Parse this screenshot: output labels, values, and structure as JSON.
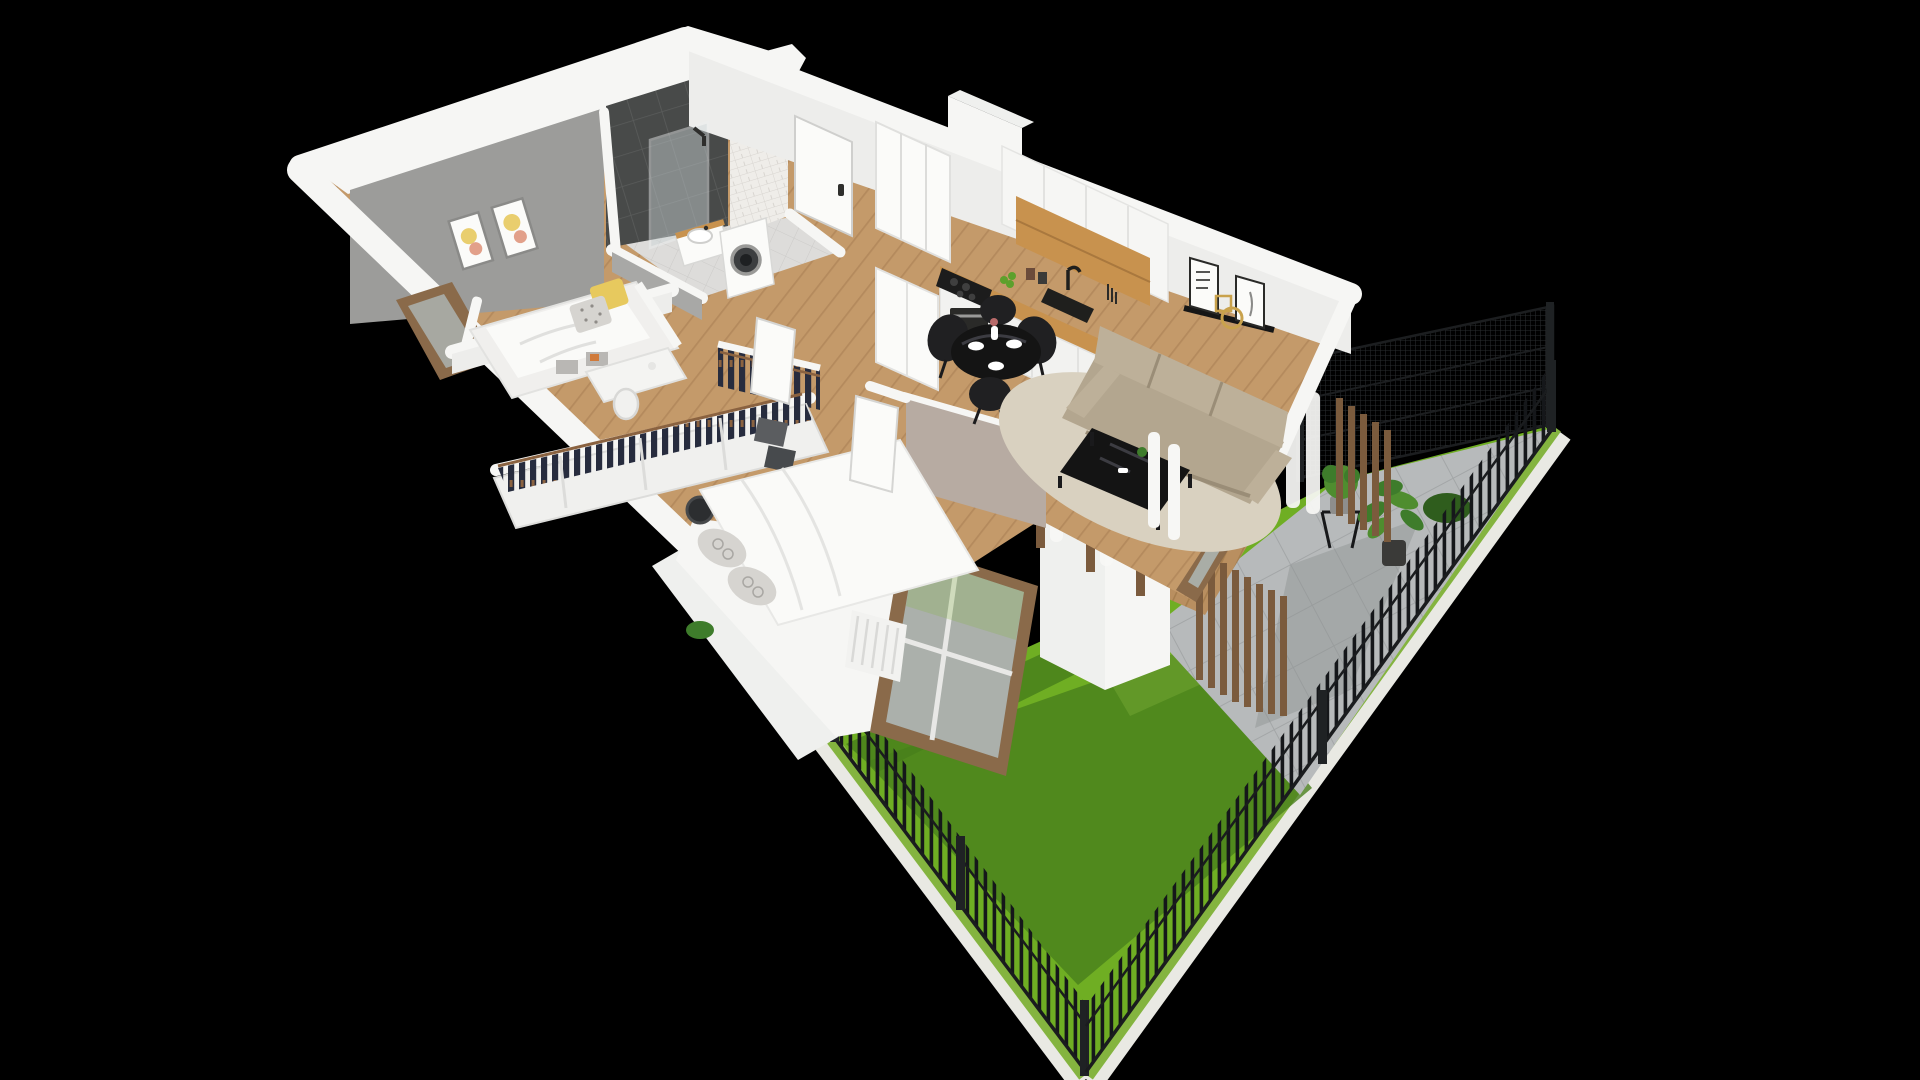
{
  "meta": {
    "kind": "3d-isometric-floor-plan-render",
    "canvas": {
      "width": 1920,
      "height": 1080
    },
    "background": "black",
    "visible_text": "none"
  },
  "colors": {
    "background": "#000000",
    "wallTop": "#f6f6f4",
    "wallFace": "#ededeb",
    "wallOuter": "#eff0ee",
    "grayAccent": "#9c9c9a",
    "taupeWall": "#b7aba2",
    "charcoalTile": "#484a49",
    "charcoalGrout": "#5a5c5b",
    "subwayTile": "#efede9",
    "subwayGrout": "#d8d5d0",
    "woodFloor": "#c49a6a",
    "woodGrain": "#a87e52",
    "terraceDeck": "#b98f60",
    "deckGrain": "#9e7647",
    "bathFloor": "#dddcda",
    "bathGrout": "#cccbc9",
    "counterOak": "#c8924e",
    "lawn": "#6fae23",
    "lawnShadow": "#49801b",
    "lawnLight": "#84b43f",
    "paleBorder": "#e9e9e3",
    "patio": "#b7babb",
    "patioGrout": "#a3a6a7",
    "patioShadow": "#8f9293",
    "fence": "#15171a",
    "fencePost": "#1f2224",
    "woodSlat": "#7b5b3d",
    "windowFrame": "#8a6a4a",
    "glass": "#aeb8b6",
    "sofa": "#b3a68f",
    "sofaLight": "#bdb099",
    "rug": "#d9d1c0",
    "tableBlack": "#141414",
    "tableSheen": "#3c3c42",
    "chairBlack": "#202022",
    "clothes": "#272c3e",
    "hanger": "#8a6240",
    "plantGreen": "#3e7c2b",
    "plantLight": "#4f8d2f",
    "bushDark": "#2f5d1d",
    "apples": "#5da02c",
    "gold": "#c9a24c",
    "white": "#fbfbf9",
    "duvet": "#fafaf8",
    "pillowGray": "#d6d4d0",
    "pillowYellow": "#e7c95e",
    "radiator": "#f2f2f0",
    "boxGray": "#5b5d60",
    "drum": "#3c3e40",
    "curtain": "#f7f7f5",
    "applianceDark": "#2a2a28"
  },
  "scene": {
    "view": "cutaway apartment seen from above at an angle, private garden at lower right, pure black surroundings",
    "building": {
      "rooms": [
        {
          "name": "small-bedroom",
          "features": [
            "gray accent wall",
            "two framed pastel botanical prints",
            "single day-bed with storage cubbies",
            "yellow pillow",
            "gray polka-dot pillow",
            "white desk with white chair",
            "wood framed window"
          ]
        },
        {
          "name": "bathroom",
          "features": [
            "charcoal tile feature wall",
            "glass walk-in shower with black fixture",
            "white vanity with wood top and basin",
            "white washing machine with dark drum door",
            "white subway-tile chimney column",
            "light gray tile floor"
          ]
        },
        {
          "name": "entry-hall",
          "features": [
            "white entrance door with dark handle",
            "tall white wardrobe",
            "oak floor",
            "exterior chimney block on outer wall"
          ]
        },
        {
          "name": "walk-in-closet",
          "features": [
            "open rail of dark hanging clothes on wooden hangers"
          ]
        },
        {
          "name": "kitchen-dining",
          "features": [
            "white upper cabinets with oak open shelf",
            "oak worktop",
            "black cooktop with oven",
            "black sink and faucet",
            "tall white cabinet column",
            "green apples on counter",
            "round black dining table",
            "four black shell chairs",
            "white plates and vase with flowers"
          ]
        },
        {
          "name": "living-room",
          "features": [
            "taupe three-seat sofa",
            "black glass coffee table with small plant",
            "beige rug",
            "black picture-ledge shelf with two art frames and round gold mirror",
            "wood framed sliding glass door to terrace",
            "white curtains"
          ]
        },
        {
          "name": "master-bedroom",
          "features": [
            "double bed with white duvet",
            "gray patterned pillows",
            "open wardrobe with dark hanging clothes",
            "white cube storage with dark boxes",
            "black round basket",
            "large wood framed window to the garden",
            "white ribbed radiator",
            "open white door"
          ]
        }
      ],
      "materials": {
        "floors": "oak planks",
        "walls": "white cut walls"
      }
    },
    "garden": {
      "features": [
        "bright green lawn with large diagonal building shadow",
        "gray concrete-slab patio",
        "black vertical-picket fence along two lower edges",
        "tall black wire-mesh fence panels on upper-right edge",
        "vertical wood-slat privacy screens",
        "pergola posts with hanging white outdoor curtains",
        "wooden terrace deck",
        "white masonry planter block",
        "white planter boxes with greenery",
        "potted monstera",
        "potted shrub on black stand",
        "dark green corner hedge",
        "pale outer border strip"
      ]
    }
  }
}
